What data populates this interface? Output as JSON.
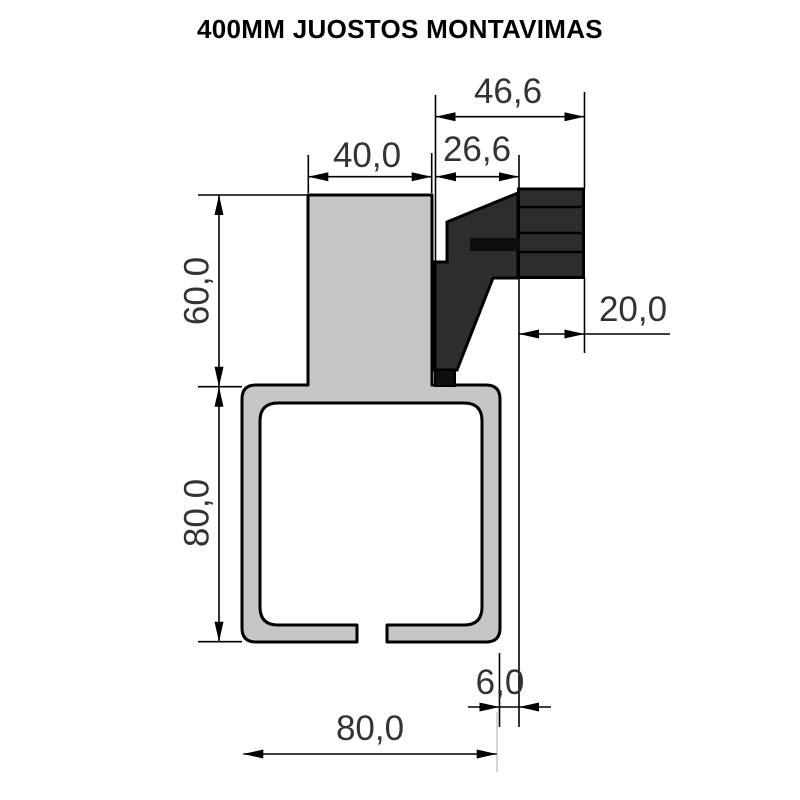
{
  "title": "400MM JUOSTOS MONTAVIMAS",
  "dims": {
    "overall_width": "46,6",
    "bracket_width": "26,6",
    "stem_width": "40,0",
    "stem_height": "60,0",
    "channel_height": "80,0",
    "block_depth": "20,0",
    "edge_offset": "6,0",
    "channel_width": "80,0"
  },
  "colors": {
    "profile_fill": "#c6c6c6",
    "bracket_fill": "#2d2d2d",
    "accent_black": "#0e0e0e",
    "faint_line": "#c9c9c9"
  }
}
